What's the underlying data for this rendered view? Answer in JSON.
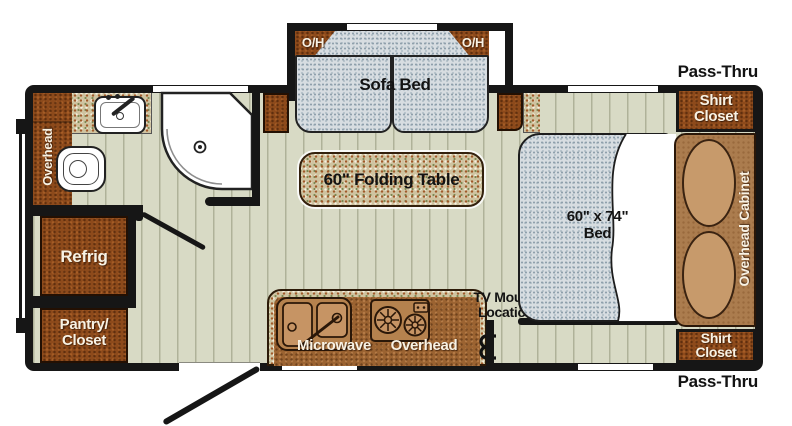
{
  "exterior": {
    "pass_thru_top": "Pass-Thru",
    "pass_thru_bottom": "Pass-Thru"
  },
  "slideout": {
    "oh_left": "O/H",
    "oh_right": "O/H",
    "sofa": "Sofa Bed"
  },
  "bath": {
    "overhead": "Overhead"
  },
  "galley": {
    "refrig": "Refrig",
    "pantry_line1": "Pantry/",
    "pantry_line2": "Closet",
    "table": "60\" Folding Table",
    "microwave": "Microwave",
    "overhead": "Overhead"
  },
  "bedroom": {
    "bed_line1": "60\" x 74\"",
    "bed_line2": "Bed",
    "overhead_cabinet": "Overhead Cabinet",
    "shirt_top_line1": "Shirt",
    "shirt_top_line2": "Closet",
    "shirt_bottom_line1": "Shirt",
    "shirt_bottom_line2": "Closet",
    "tv_line1": "TV Mound",
    "tv_line2": "Location"
  },
  "colors": {
    "wall": "#161616",
    "floor": "#d8dac5",
    "cabinet_dark": "#8d4a1b",
    "cabinet_mid": "#ab7c4e",
    "pillow": "#c79a6b",
    "counter_speckle": "#cfc3a0",
    "counter_laminate": "#9b6331",
    "mattress": "#d7dde1",
    "label_white": "#f8f2e4",
    "label_black": "#131313"
  }
}
